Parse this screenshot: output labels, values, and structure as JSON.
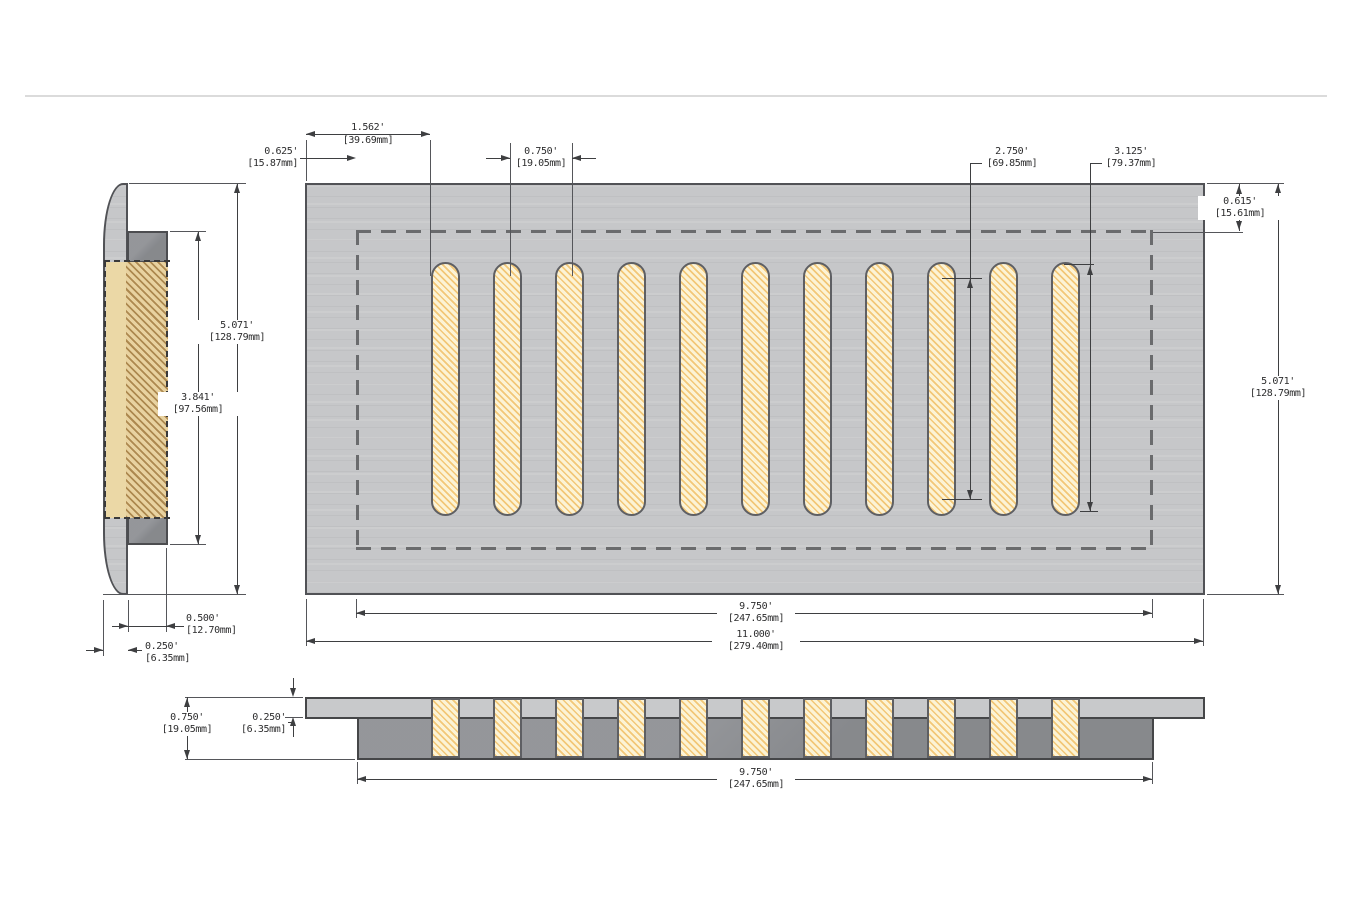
{
  "drawing": {
    "description": "Dimensioned three-view drawing of a slotted vent register",
    "slot_count": 11,
    "colors": {
      "plate": "#c6c7c9",
      "sub_frame": "#8e9094",
      "slot_fill": "#fcf3d5",
      "slot_hatch": "#f2c573",
      "outline": "#515256"
    }
  },
  "dims": {
    "slot_offset_left": {
      "in": "1.562'",
      "mm": "[39.69mm]"
    },
    "margin_left": {
      "in": "0.625'",
      "mm": "[15.87mm]"
    },
    "slot_pitch": {
      "in": "0.750'",
      "mm": "[19.05mm]"
    },
    "slot_inner_length": {
      "in": "2.750'",
      "mm": "[69.85mm]"
    },
    "slot_length": {
      "in": "3.125'",
      "mm": "[79.37mm]"
    },
    "margin_top": {
      "in": "0.615'",
      "mm": "[15.61mm]"
    },
    "overall_height_right": {
      "in": "5.071'",
      "mm": "[128.79mm]"
    },
    "overall_height_side": {
      "in": "5.071'",
      "mm": "[128.79mm]"
    },
    "opening_height_side": {
      "in": "3.841'",
      "mm": "[97.56mm]"
    },
    "drop_depth": {
      "in": "0.500'",
      "mm": "[12.70mm]"
    },
    "flange_depth": {
      "in": "0.250'",
      "mm": "[6.35mm]"
    },
    "opening_width": {
      "in": "9.750'",
      "mm": "[247.65mm]"
    },
    "overall_width": {
      "in": "11.000'",
      "mm": "[279.40mm]"
    },
    "section_height": {
      "in": "0.750'",
      "mm": "[19.05mm]"
    },
    "section_plate_thick": {
      "in": "0.250'",
      "mm": "[6.35mm]"
    },
    "section_opening_width": {
      "in": "9.750'",
      "mm": "[247.65mm]"
    }
  }
}
